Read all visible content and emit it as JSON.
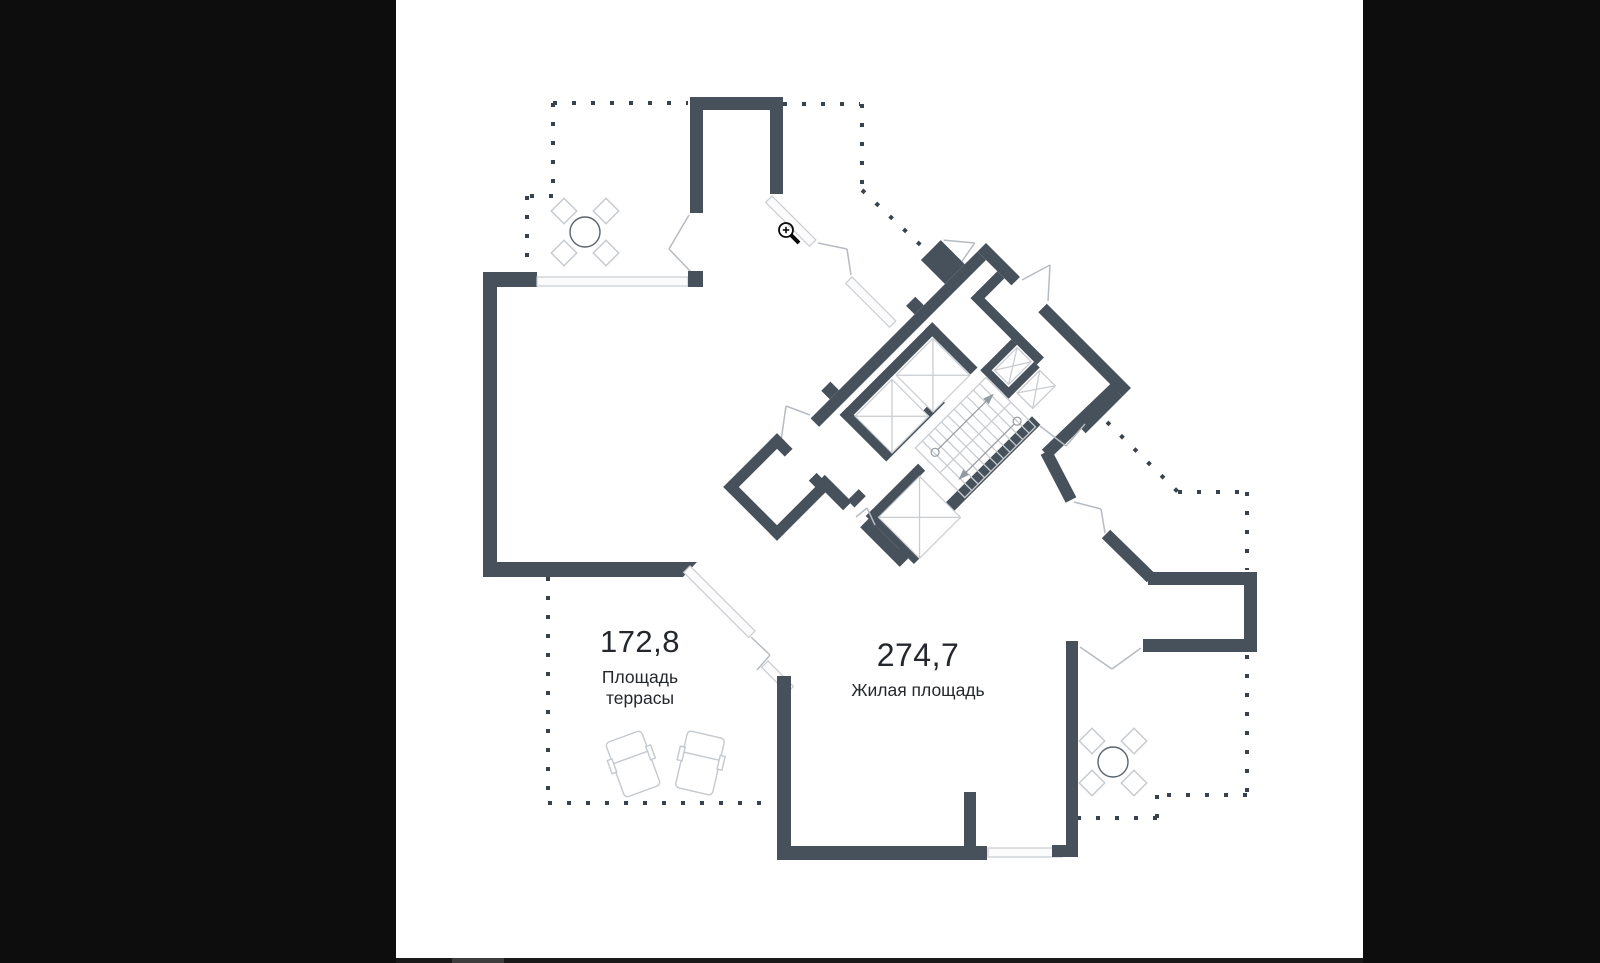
{
  "colors": {
    "letterbox": "#0d0d0d",
    "canvas": "#ffffff",
    "bottom_bar": "#191919",
    "bottom_bar_accent": "#3d3d3d",
    "wall": "#46515c",
    "thin": "#c9cdd1",
    "swing": "#b6bbc1",
    "dots": "#39434d",
    "furniture": "#c4c9ce",
    "table_stroke": "#59636d",
    "stair_arrow": "#939aa1",
    "text": "#24282c"
  },
  "plan": {
    "terrace": {
      "area_value": "172,8",
      "label_line1": "Площадь",
      "label_line2": "террасы"
    },
    "living": {
      "area_value": "274,7",
      "label": "Жилая площадь"
    }
  },
  "icons": {
    "cursor": "zoom-in-magnifier-icon"
  }
}
